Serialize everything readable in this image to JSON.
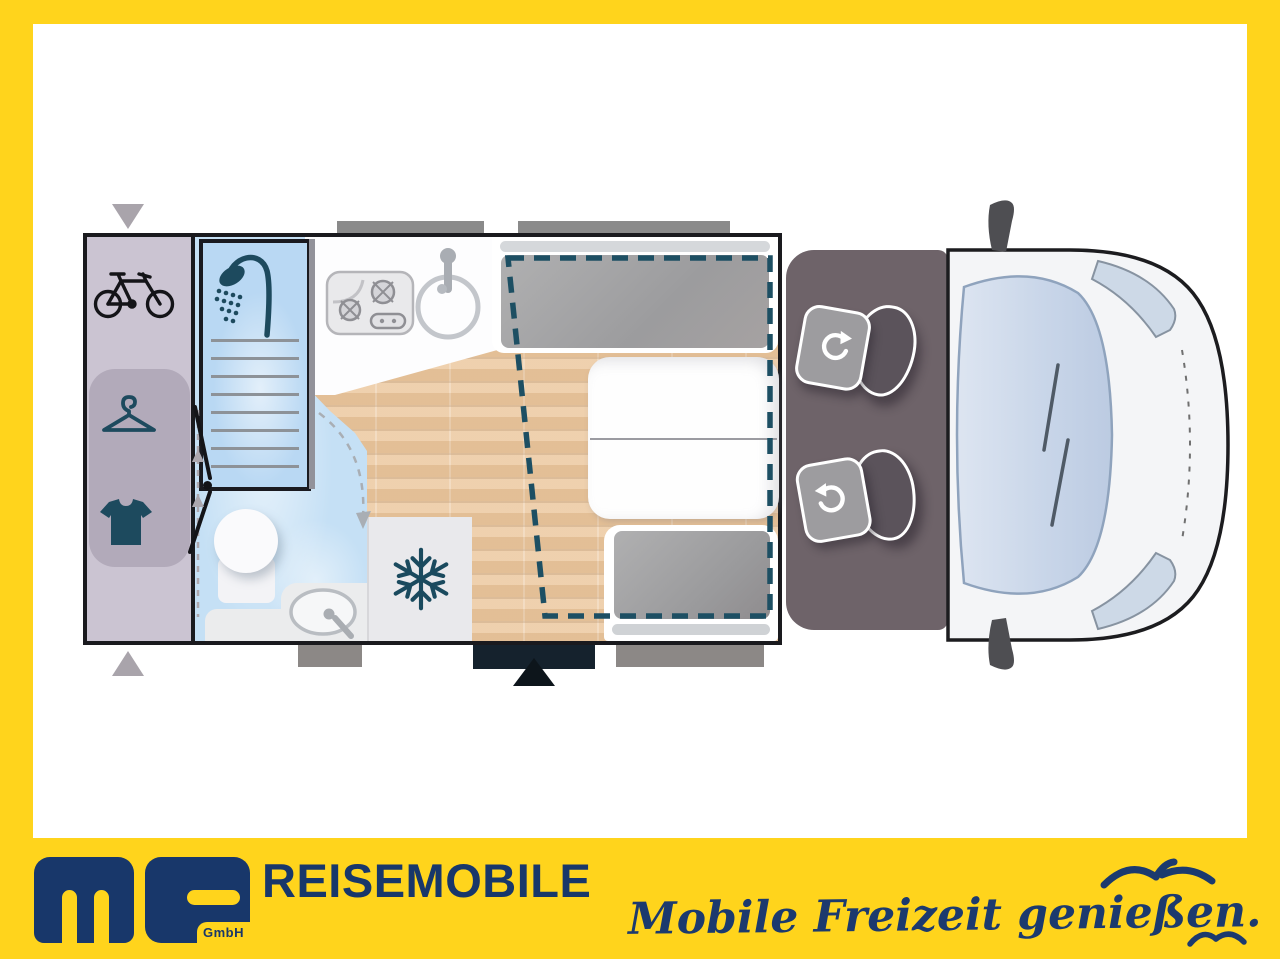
{
  "footer": {
    "logo_text": "ms",
    "logo_subtext": "GmbH",
    "company": "REISEMOBILE",
    "slogan": "Mobile Freizeit genießen."
  },
  "colors": {
    "frame_yellow": "#FFD41C",
    "brand_navy": "#18376A",
    "plan_icon_teal": "#1D4A5E",
    "drop_bed_dash": "#1D4F63",
    "wood_floor": "#ECC9A1",
    "bathroom_blue": "#C5E0F5",
    "garage_mauve": "#CBC4D2",
    "wardrobe_mauve": "#B2AABA",
    "cab_floor": "#6E6369",
    "cushion_gray": "#A6A6A8",
    "vehicle_body": "#F4F5F7",
    "windshield_blue": "#CCD8EA"
  },
  "floorplan_icons": {
    "bicycle-icon": "rear garage bike storage",
    "hanger-icon": "wardrobe",
    "tshirt-icon": "clothes locker",
    "shower-icon": "shower cubicle",
    "stove-icon": "two-burner hob",
    "kitchen-sink-icon": "round kitchen sink",
    "snowflake-icon": "refrigerator",
    "rotate-icon": "swivel cab seat",
    "entry-arrow-icon": "entrance door",
    "drop-down-bed-outline": "pull-down bed"
  }
}
